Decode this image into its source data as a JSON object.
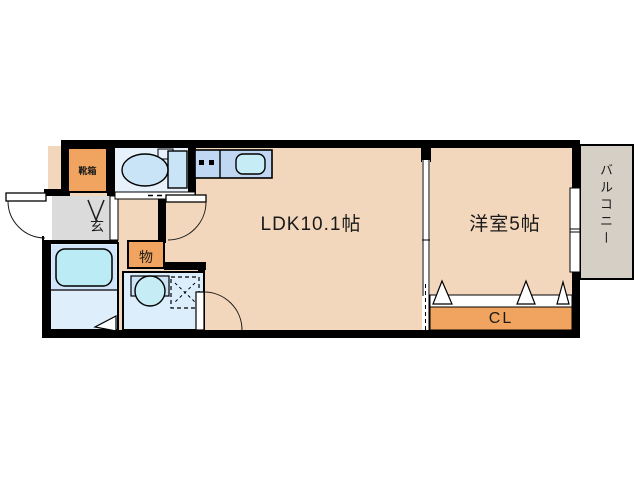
{
  "title": "floor-plan",
  "floorplan": {
    "labels": {
      "ldk": "LDK10.1帖",
      "western_room": "洋室5帖",
      "balcony": "バルコニー",
      "closet": "CL",
      "entrance": "玄",
      "storage": "物",
      "shoe_cabinet": "靴箱"
    },
    "fixtures": [
      "toilet-icon",
      "kitchen-sink-icon",
      "stove-burners-icon",
      "bathtub-icon",
      "washbasin-icon",
      "washing-machine-space-icon",
      "entrance-door-arc",
      "hall-door-arc",
      "washroom-door-arc",
      "closet-folding-door-triangles",
      "sliding-window",
      "entrance-step-arrow"
    ],
    "colors": {
      "wall": "#000000",
      "room_floor": "#F2D7BC",
      "entrance_floor": "#DBDBDB",
      "cabinet_orange": "#F0A45F",
      "toilet_room_blue": "#E6F1FB",
      "bath_floor_blue": "#DFEEFB",
      "bath_upper_blue": "#CFE4F8",
      "washroom_blue": "#DCEEFB",
      "fixture_blue": "#C9E4F6",
      "bathtub_cyan": "#BBECF6",
      "kitchen_counter_blue": "#BFD7F2",
      "sink_cyan": "#C6EDF5",
      "balcony_gray": "#D6CFC6",
      "text": "#1a1a1a"
    }
  }
}
